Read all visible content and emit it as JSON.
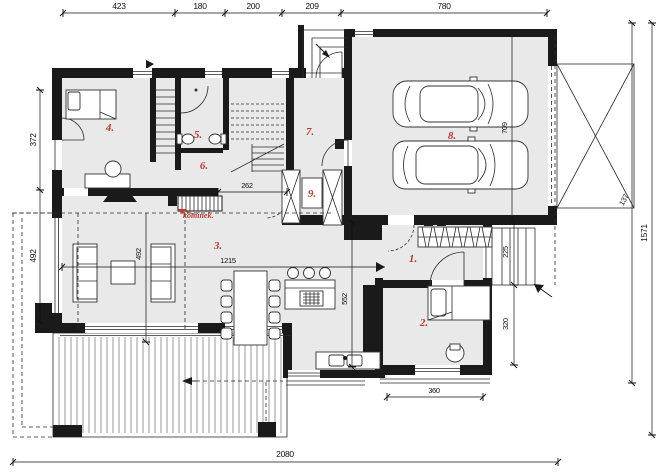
{
  "drawing": {
    "type": "architectural-floor-plan",
    "annotation_fireplace": "kominek."
  },
  "rooms": [
    {
      "id": "room-1",
      "label": "1."
    },
    {
      "id": "room-2",
      "label": "2."
    },
    {
      "id": "room-3",
      "label": "3."
    },
    {
      "id": "room-4",
      "label": "4."
    },
    {
      "id": "room-5",
      "label": "5."
    },
    {
      "id": "room-6",
      "label": "6."
    },
    {
      "id": "room-7",
      "label": "7."
    },
    {
      "id": "room-8",
      "label": "8."
    },
    {
      "id": "room-9",
      "label": "9."
    }
  ],
  "dimensions": {
    "top": [
      "423",
      "180",
      "200",
      "209",
      "780"
    ],
    "left": [
      "372",
      "492"
    ],
    "right": [
      "1571"
    ],
    "bottom": [
      "2080"
    ],
    "interior": {
      "hall_opening": "262",
      "living_width": "1215",
      "living_depth": "492",
      "kitchen_depth": "552",
      "garage_depth": "709",
      "side_steps_upper": "225",
      "side_steps_lower": "320",
      "bedroom2_width": "360",
      "canopy_edge": "137"
    }
  },
  "colors": {
    "wall": "#1a1a1a",
    "floor": "#e9e9e9",
    "label_red": "#c0392b",
    "background": "#ffffff"
  }
}
